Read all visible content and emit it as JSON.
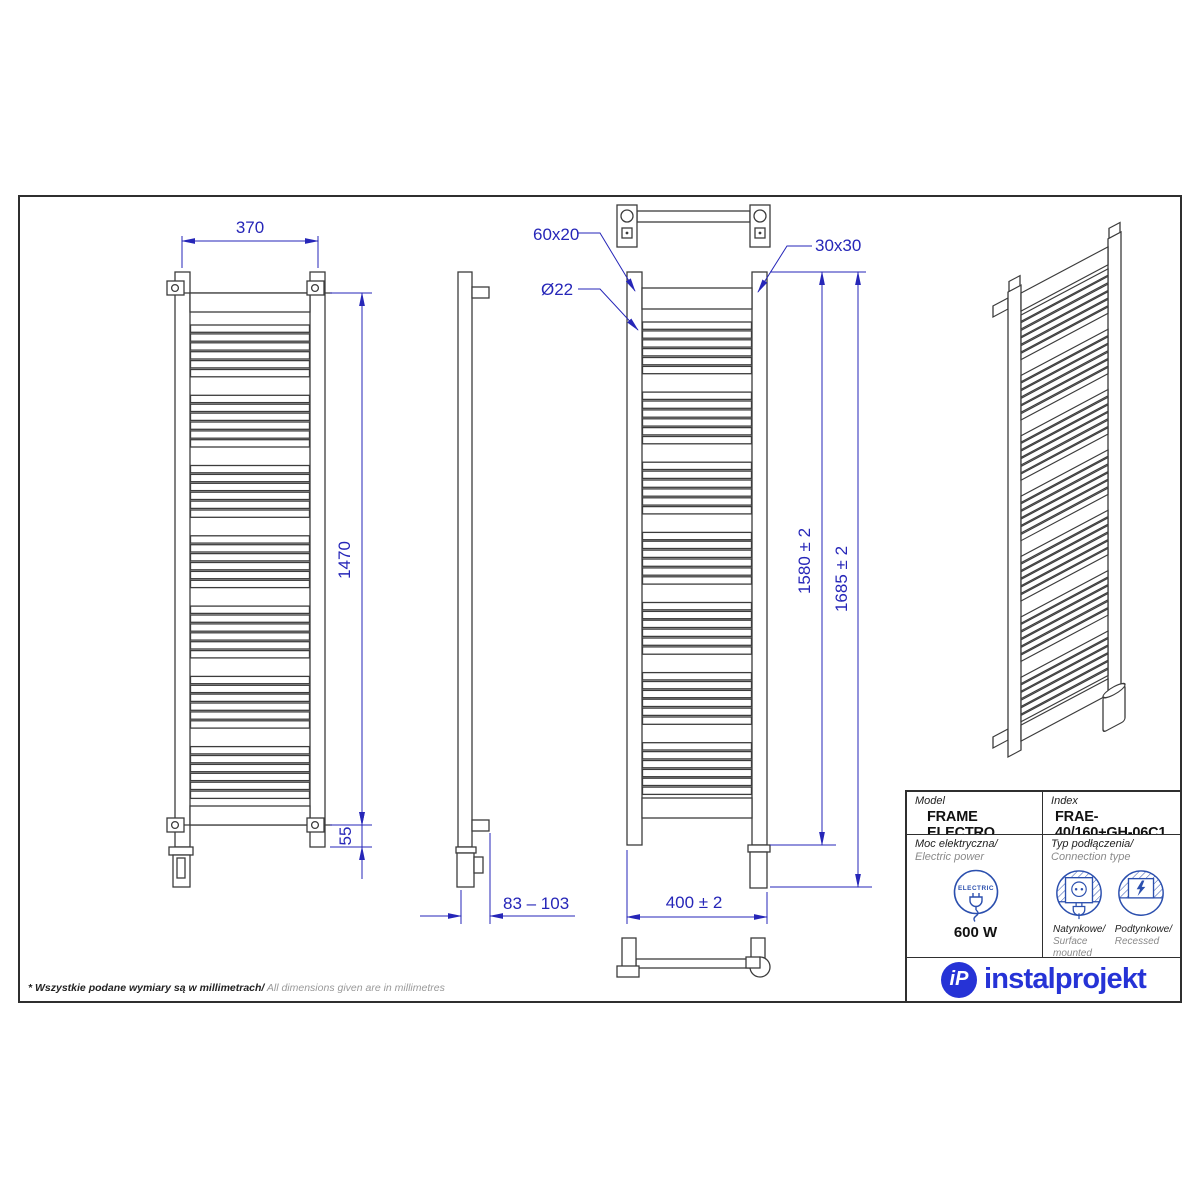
{
  "dims": {
    "top_width": "370",
    "axis_height": "1470",
    "bottom_offset": "55",
    "flat_tube": "60x20",
    "round_tube": "Ø22",
    "profile": "30x30",
    "height_inner": "1580 ± 2",
    "height_total": "1685 ± 2",
    "wall_distance": "83 – 103",
    "total_width": "400 ± 2"
  },
  "table": {
    "model_label": "Model",
    "model_value": "FRAME ELECTRO",
    "index_label": "Index",
    "index_value": "FRAE-40/160+GH-06C1",
    "power_label_pl": "Moc elektryczna/",
    "power_label_en": " Electric power",
    "electric_badge": "ELECTRIC",
    "power_value": "600 W",
    "connection_label_pl": "Typ podłączenia/",
    "connection_label_en": "Connection type",
    "surface_pl": "Natynkowe/",
    "surface_en": "Surface mounted",
    "recessed_pl": "Podtynkowe/",
    "recessed_en": "Recessed"
  },
  "logo": {
    "monogram": "iP",
    "name": "instalprojekt"
  },
  "footer": {
    "note_pl": "* Wszystkie podane wymiary są w millimetrach/",
    "note_en": " All dimensions given are in millimetres"
  },
  "colors": {
    "line": "#3c3c3c",
    "dimension": "#2626b8",
    "icon_blue": "#2b4fae",
    "logo_blue": "#2633d6"
  },
  "radiator": {
    "rung_groups": 7,
    "rungs_per_group": 6
  }
}
